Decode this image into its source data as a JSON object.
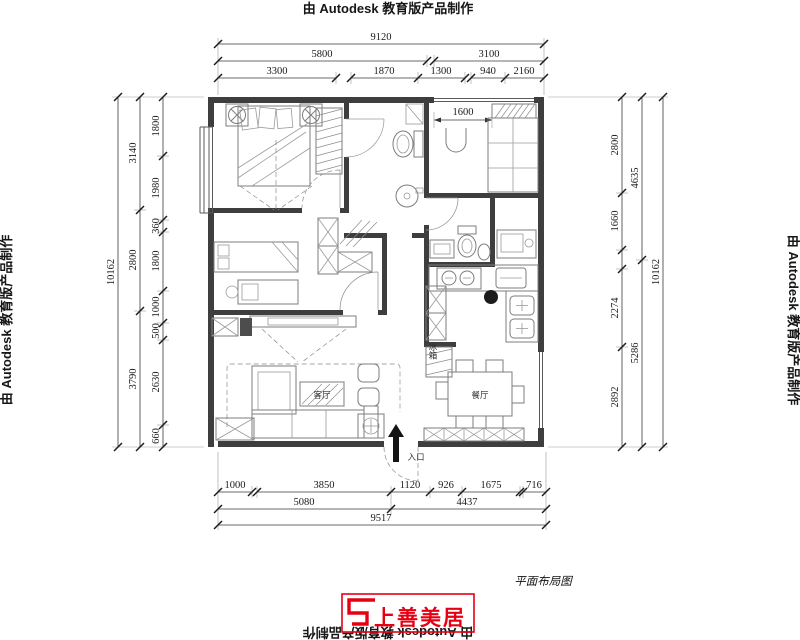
{
  "watermarks": {
    "top": "由 Autodesk 教育版产品制作",
    "left": "由 Autodesk 教育版产品制作",
    "right": "由 Autodesk 教育版产品制作",
    "bottom": "由 Autodesk 教育版产品制作"
  },
  "drawing_title": "平面布局图",
  "logo": {
    "text": "上善美居",
    "color": "#e60012"
  },
  "labels": {
    "living_room": "客厅",
    "dining_room": "餐厅",
    "entrance": "入口",
    "fridge": "冰箱",
    "balcony_width": "1600"
  },
  "dimensions": {
    "top": {
      "overall": "9120",
      "row2": [
        "5800",
        "3100"
      ],
      "row3": [
        "3300",
        "1870",
        "1300",
        "940",
        "2160"
      ]
    },
    "bottom": {
      "row1": [
        "1000",
        "3850",
        "1120",
        "926",
        "1675",
        "716"
      ],
      "row2": [
        "5080",
        "4437"
      ],
      "overall": "9517"
    },
    "left": {
      "outer": "10162",
      "middle": [
        "3140",
        "2800",
        "3790"
      ],
      "inner": [
        "1800",
        "1980",
        "360",
        "1800",
        "1000",
        "500",
        "2630",
        "660"
      ]
    },
    "right": {
      "outer": "10162",
      "middle": [
        "4635",
        "5286"
      ],
      "inner": [
        "2800",
        "1660",
        "2274",
        "2892"
      ]
    }
  }
}
